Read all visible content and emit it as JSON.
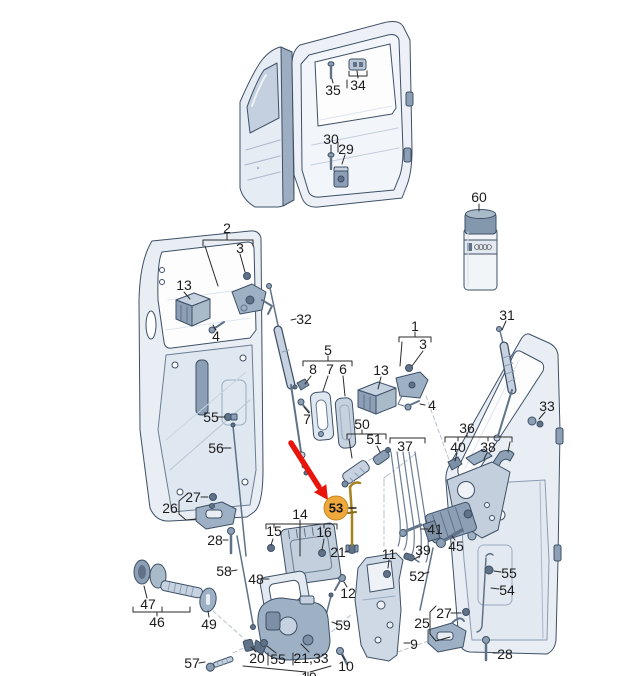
{
  "meta": {
    "width": 617,
    "height": 676,
    "background": "#ffffff",
    "description": "exploded parts diagram - van rear and sliding door lock mechanisms"
  },
  "colors": {
    "line": "#3e5066",
    "body_fill": "#e9eef5",
    "panel_fill": "#dfe7f0",
    "window_fill": "#c4cfe0",
    "part_light": "#c7d2e0",
    "part_mid": "#9db0c4",
    "part_dark": "#5f7288",
    "highlight_rod": "#a8821e",
    "label_color": "#1b1b1b"
  },
  "highlight": {
    "part_number": "53",
    "badge_color": "#efa83c",
    "badge_border": "#c8871c",
    "arrow_color": "#e8150d",
    "x": 336,
    "y": 508
  },
  "callouts": [
    {
      "key": "35",
      "n": "35",
      "x": 333,
      "y": 90
    },
    {
      "key": "34",
      "n": "34",
      "x": 358,
      "y": 85
    },
    {
      "key": "30",
      "n": "30",
      "x": 331,
      "y": 139
    },
    {
      "key": "29",
      "n": "29",
      "x": 346,
      "y": 149
    },
    {
      "key": "60",
      "n": "60",
      "x": 479,
      "y": 197
    },
    {
      "key": "2",
      "n": "2",
      "x": 227,
      "y": 228
    },
    {
      "key": "3-left",
      "n": "3",
      "x": 240,
      "y": 248
    },
    {
      "key": "13-left",
      "n": "13",
      "x": 184,
      "y": 285
    },
    {
      "key": "32",
      "n": "32",
      "x": 304,
      "y": 319
    },
    {
      "key": "4-left",
      "n": "4",
      "x": 216,
      "y": 336
    },
    {
      "key": "55-door-left",
      "n": "55",
      "x": 211,
      "y": 417
    },
    {
      "key": "56",
      "n": "56",
      "x": 216,
      "y": 448
    },
    {
      "key": "5",
      "n": "5",
      "x": 328,
      "y": 350
    },
    {
      "key": "8",
      "n": "8",
      "x": 313,
      "y": 369
    },
    {
      "key": "7-upper",
      "n": "7",
      "x": 330,
      "y": 369
    },
    {
      "key": "6",
      "n": "6",
      "x": 343,
      "y": 369
    },
    {
      "key": "7-lower",
      "n": "7",
      "x": 307,
      "y": 419
    },
    {
      "key": "13-right",
      "n": "13",
      "x": 381,
      "y": 370
    },
    {
      "key": "1",
      "n": "1",
      "x": 415,
      "y": 326
    },
    {
      "key": "3-right",
      "n": "3",
      "x": 423,
      "y": 344
    },
    {
      "key": "4-right",
      "n": "4",
      "x": 432,
      "y": 405
    },
    {
      "key": "31",
      "n": "31",
      "x": 507,
      "y": 315
    },
    {
      "key": "33",
      "n": "33",
      "x": 547,
      "y": 406
    },
    {
      "key": "50",
      "n": "50",
      "x": 362,
      "y": 424
    },
    {
      "key": "51",
      "n": "51",
      "x": 374,
      "y": 439
    },
    {
      "key": "37",
      "n": "37",
      "x": 405,
      "y": 446
    },
    {
      "key": "36",
      "n": "36",
      "x": 467,
      "y": 428
    },
    {
      "key": "40",
      "n": "40",
      "x": 458,
      "y": 447
    },
    {
      "key": "38",
      "n": "38",
      "x": 488,
      "y": 447
    },
    {
      "key": "41",
      "n": "41",
      "x": 435,
      "y": 529
    },
    {
      "key": "45",
      "n": "45",
      "x": 456,
      "y": 546
    },
    {
      "key": "39",
      "n": "39",
      "x": 423,
      "y": 550
    },
    {
      "key": "52",
      "n": "52",
      "x": 417,
      "y": 576
    },
    {
      "key": "55-door-right",
      "n": "55",
      "x": 509,
      "y": 573
    },
    {
      "key": "54",
      "n": "54",
      "x": 507,
      "y": 590
    },
    {
      "key": "27-right",
      "n": "27",
      "x": 444,
      "y": 613
    },
    {
      "key": "25",
      "n": "25",
      "x": 422,
      "y": 623
    },
    {
      "key": "9",
      "n": "9",
      "x": 414,
      "y": 644
    },
    {
      "key": "28-right",
      "n": "28",
      "x": 505,
      "y": 654
    },
    {
      "key": "26",
      "n": "26",
      "x": 170,
      "y": 508
    },
    {
      "key": "27-left",
      "n": "27",
      "x": 193,
      "y": 497
    },
    {
      "key": "28-left",
      "n": "28",
      "x": 215,
      "y": 540
    },
    {
      "key": "14",
      "n": "14",
      "x": 300,
      "y": 514
    },
    {
      "key": "15",
      "n": "15",
      "x": 274,
      "y": 531
    },
    {
      "key": "16",
      "n": "16",
      "x": 324,
      "y": 532
    },
    {
      "key": "53",
      "n": "53",
      "x": 336,
      "y": 508,
      "badge": true
    },
    {
      "key": "21",
      "n": "21",
      "x": 338,
      "y": 552
    },
    {
      "key": "11",
      "n": "11",
      "x": 389,
      "y": 554
    },
    {
      "key": "12",
      "n": "12",
      "x": 348,
      "y": 593
    },
    {
      "key": "48",
      "n": "48",
      "x": 256,
      "y": 579
    },
    {
      "key": "58",
      "n": "58",
      "x": 224,
      "y": 571
    },
    {
      "key": "59",
      "n": "59",
      "x": 343,
      "y": 625
    },
    {
      "key": "47",
      "n": "47",
      "x": 148,
      "y": 604
    },
    {
      "key": "46",
      "n": "46",
      "x": 157,
      "y": 622
    },
    {
      "key": "49",
      "n": "49",
      "x": 209,
      "y": 624
    },
    {
      "key": "57",
      "n": "57",
      "x": 192,
      "y": 663
    },
    {
      "key": "20",
      "n": "20",
      "x": 257,
      "y": 658
    },
    {
      "key": "55-lock",
      "n": "55",
      "x": 278,
      "y": 659
    },
    {
      "key": "21-33",
      "n": "21,33",
      "x": 311,
      "y": 658
    },
    {
      "key": "10",
      "n": "10",
      "x": 346,
      "y": 666
    },
    {
      "key": "19-partial",
      "n": "19",
      "x": 309,
      "y": 677,
      "clipped": true
    }
  ]
}
